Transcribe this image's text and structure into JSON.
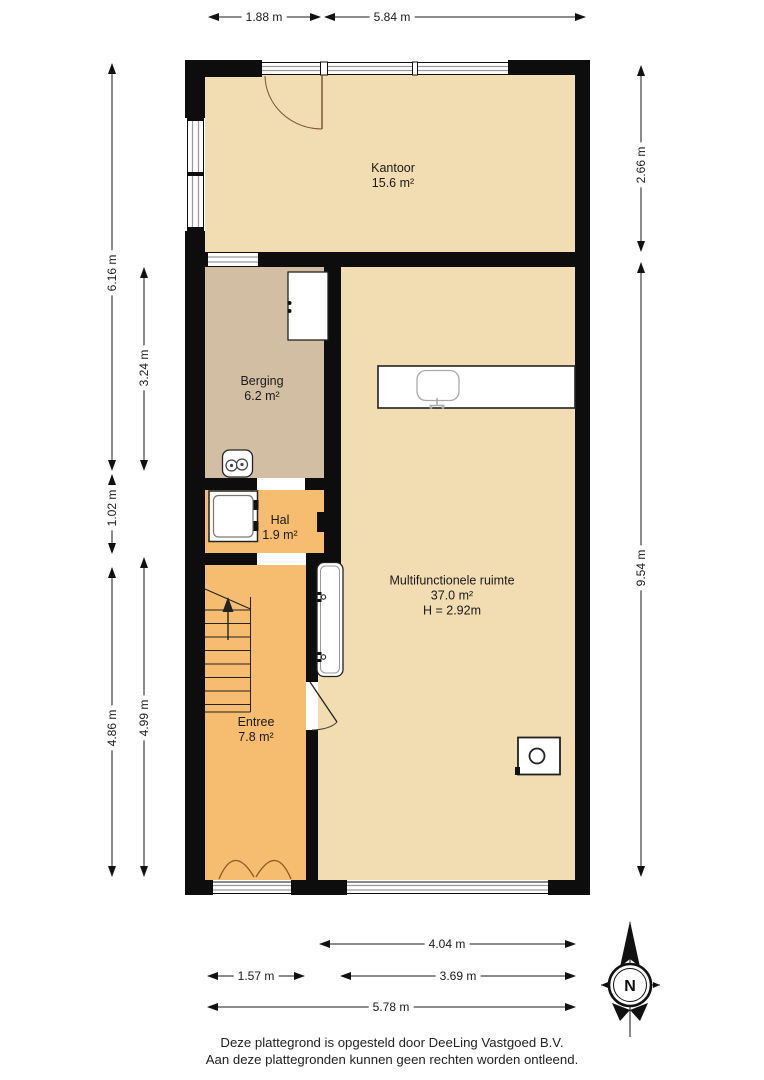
{
  "colors": {
    "room_tan": "#f2dcb2",
    "room_brown": "#d2bfa3",
    "room_orange": "#f6bc70",
    "wall": "#0d0d0d",
    "window_line": "#9a9a9a",
    "dim_line": "#1a1a1a",
    "text": "#1a1a1a"
  },
  "rooms": [
    {
      "name": "Kantoor",
      "area": "15.6 m²"
    },
    {
      "name": "Berging",
      "area": "6.2 m²"
    },
    {
      "name": "Hal",
      "area": "1.9 m²"
    },
    {
      "name": "Entree",
      "area": "7.8 m²"
    },
    {
      "name": "Multifunctionele ruimte",
      "area": "37.0 m²",
      "height": "H = 2.92m"
    }
  ],
  "dimensions": {
    "top": [
      "1.88 m",
      "5.84 m"
    ],
    "left": [
      "6.16 m",
      "3.24 m",
      "1.02 m",
      "4.86 m",
      "4.99 m"
    ],
    "right": [
      "2.66 m",
      "9.54 m"
    ],
    "bottom": [
      "4.04 m",
      "1.57 m",
      "3.69 m",
      "5.78 m"
    ]
  },
  "compass": {
    "north_label": "N"
  },
  "footer": {
    "line1": "Deze plattegrond is opgesteld door DeeLing Vastgoed B.V.",
    "line2": "Aan deze plattegronden kunnen geen rechten worden ontleend."
  }
}
